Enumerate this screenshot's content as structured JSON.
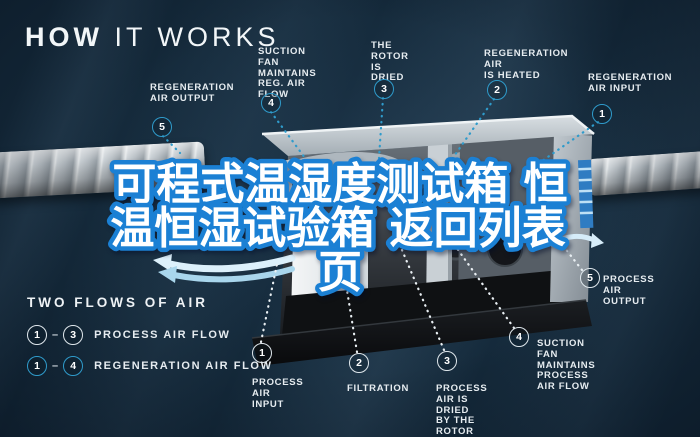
{
  "title": {
    "bold": "HOW",
    "light": "IT WORKS"
  },
  "watermark": {
    "lines": [
      "可程式温湿度测试箱 恒",
      "温恒湿试验箱 返回列表",
      "页"
    ],
    "fill": "#ffffff",
    "stroke": "#1b80d4"
  },
  "legend": {
    "heading": "TWO FLOWS OF AIR",
    "rows": [
      {
        "from": "1",
        "dash": "–",
        "to": "3",
        "label": "PROCESS AIR FLOW"
      },
      {
        "from": "1",
        "dash": "–",
        "to": "4",
        "label": "REGENERATION AIR FLOW"
      }
    ]
  },
  "callouts_top": [
    {
      "num": "5",
      "label": "REGENERATION\nAIR OUTPUT"
    },
    {
      "num": "4",
      "label": "SUCTION FAN\nMAINTAINS\nREG. AIR FLOW"
    },
    {
      "num": "3",
      "label": "THE ROTOR\nIS DRIED"
    },
    {
      "num": "2",
      "label": "REGENERATION AIR\nIS HEATED"
    },
    {
      "num": "1",
      "label": "REGENERATION\nAIR INPUT"
    }
  ],
  "callouts_bottom": [
    {
      "num": "1",
      "label": "PROCESS AIR\nINPUT"
    },
    {
      "num": "2",
      "label": "FILTRATION"
    },
    {
      "num": "3",
      "label": "PROCESS AIR IS DRIED\nBY THE ROTOR"
    },
    {
      "num": "4",
      "label": "SUCTION FAN\nMAINTAINS PROCESS\nAIR FLOW"
    },
    {
      "num": "5",
      "label": "PROCESS AIR\nOUTPUT"
    }
  ],
  "colors": {
    "background": "#14293a",
    "regeneration_accent": "#2f9bcb",
    "process_accent": "#e9eff3",
    "watermark_stroke": "#1b80d4"
  }
}
